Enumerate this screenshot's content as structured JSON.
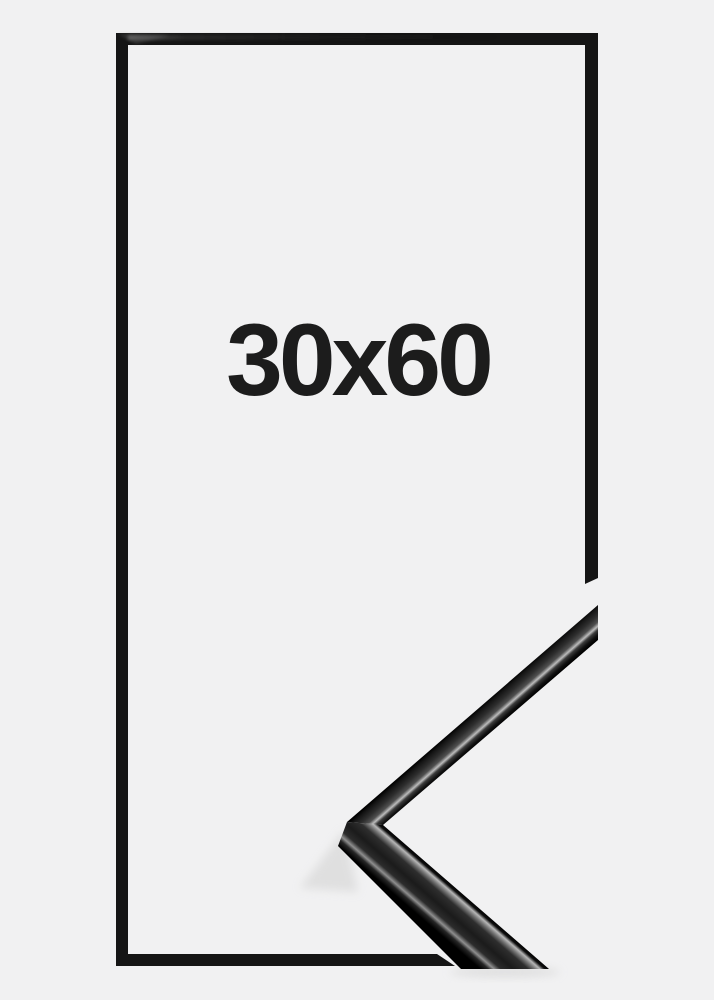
{
  "product": {
    "size_label": "30x60",
    "frame_style": "thin glossy black metal frame",
    "graphic_parts": {
      "front_view": "frame-front-view",
      "corner_detail": "frame-corner-profile"
    }
  },
  "colors": {
    "background": "#f1f1f2",
    "frame_black": "#151515",
    "label_text": "#1c1c1c",
    "specular_highlight": "#b7b7b7",
    "soft_shadow": "#d8d8d8"
  }
}
